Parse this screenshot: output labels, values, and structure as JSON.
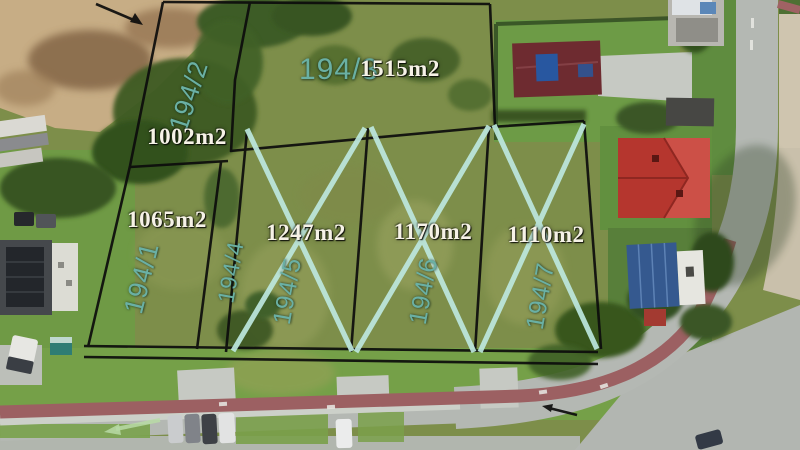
{
  "plots": [
    {
      "id": "194/1",
      "area_label": "1065m2",
      "crossed_out": false
    },
    {
      "id": "194/2",
      "area_label": "1002m2",
      "crossed_out": false
    },
    {
      "id": "194/3",
      "area_label": "1515m2",
      "crossed_out": false
    },
    {
      "id": "194/4",
      "area_label": "",
      "crossed_out": false
    },
    {
      "id": "194/5",
      "area_label": "1247m2",
      "crossed_out": true
    },
    {
      "id": "194/6",
      "area_label": "1170m2",
      "crossed_out": true
    },
    {
      "id": "194/7",
      "area_label": "1110m2",
      "crossed_out": true
    }
  ],
  "overlay_colors": {
    "plot_id_text": "#6ab0a4",
    "area_text": "#f6f2e7",
    "cross_mark": "#bde8df",
    "boundary_line": "#0c0c0c"
  }
}
